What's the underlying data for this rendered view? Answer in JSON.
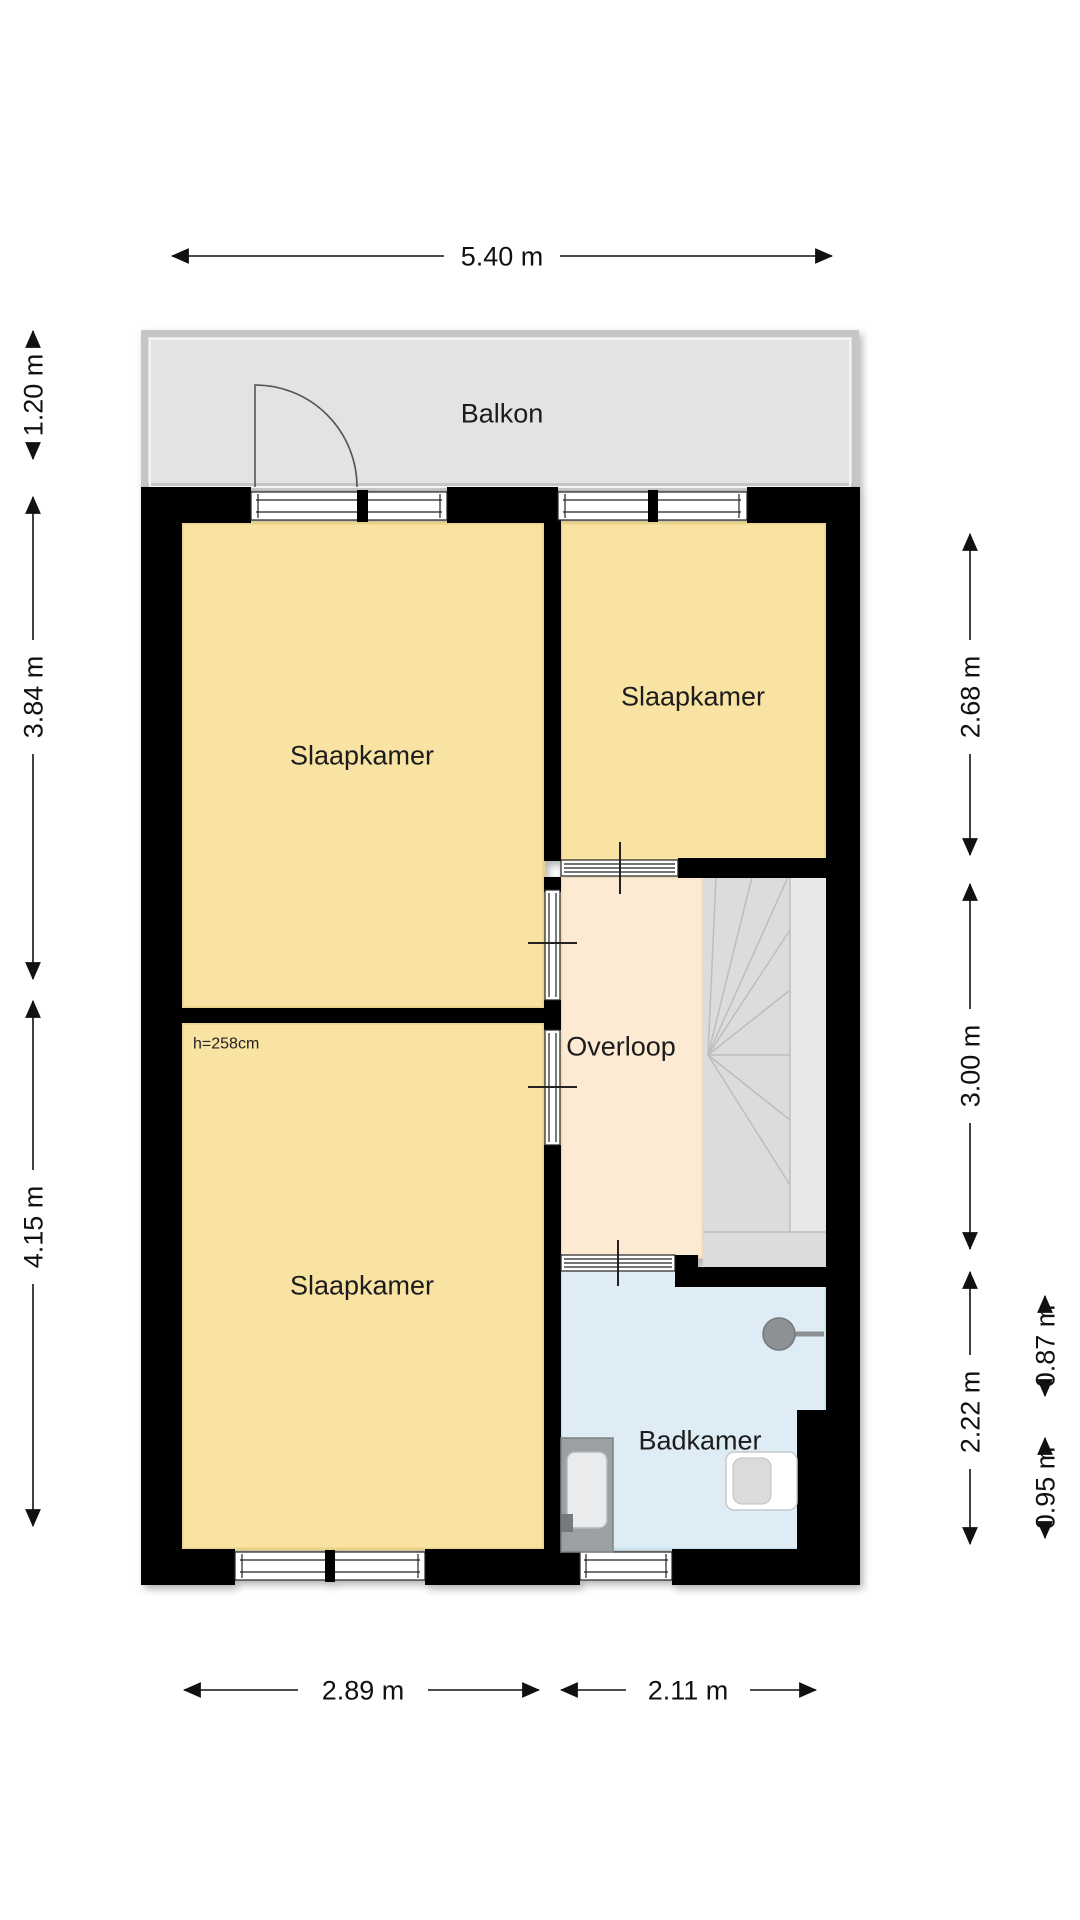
{
  "floor_plan": {
    "rooms": [
      {
        "id": "balkon",
        "label": "Balkon"
      },
      {
        "id": "slaapkamer-top-left",
        "label": "Slaapkamer"
      },
      {
        "id": "slaapkamer-top-right",
        "label": "Slaapkamer"
      },
      {
        "id": "slaapkamer-bottom-left",
        "label": "Slaapkamer"
      },
      {
        "id": "overloop",
        "label": "Overloop"
      },
      {
        "id": "badkamer",
        "label": "Badkamer"
      }
    ],
    "annotations": {
      "ceiling_height": "h=258cm"
    },
    "fixtures": [
      "staircase",
      "balcony-door",
      "shower",
      "sink-vanity",
      "toilet"
    ],
    "colors": {
      "wall": "#000000",
      "bedroom_fill": "#F8E3A3",
      "hallway_fill": "#FCEAD3",
      "bathroom_fill": "#DDECF5",
      "balcony_fill": "#E3E3E3",
      "balcony_border": "#C6C6C6",
      "stairs_fill": "#DCDCDC",
      "stairs_strip": "#E8E8E8",
      "fixture_gray": "#9BA0A3",
      "dimension_text": "#111111"
    },
    "dimensions": {
      "top": [
        {
          "label": "5.40 m"
        }
      ],
      "left": [
        {
          "label": "1.20 m"
        },
        {
          "label": "3.84 m"
        },
        {
          "label": "4.15 m"
        }
      ],
      "right_inner": [
        {
          "label": "2.68 m"
        },
        {
          "label": "3.00 m"
        },
        {
          "label": "2.22 m"
        }
      ],
      "right_outer": [
        {
          "label": "0.87 m"
        },
        {
          "label": "0.95 m"
        }
      ],
      "bottom": [
        {
          "label": "2.89 m"
        },
        {
          "label": "2.11 m"
        }
      ]
    }
  }
}
